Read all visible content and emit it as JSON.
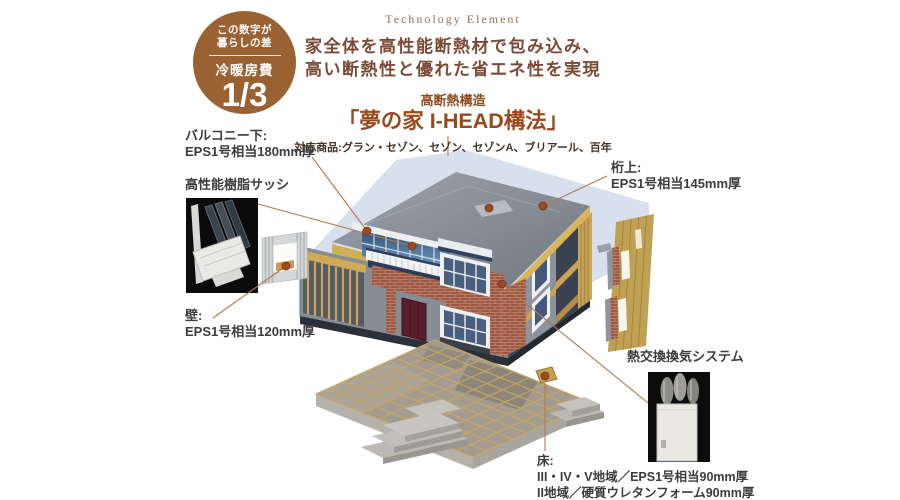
{
  "badge": {
    "line1": "この数字が",
    "line2": "暮らしの差",
    "category": "冷暖房費",
    "value": "1/3",
    "bg_color": "#9a6132"
  },
  "header": {
    "eyebrow": "Technology Element",
    "copy_line1": "家全体を高性能断熱材で包み込み、",
    "copy_line2": "高い断熱性と優れた省エネ性を実現",
    "subtitle": "高断熱構造",
    "title": "「夢の家 I-HEAD構法」",
    "products": "対応商品:グラン・セゾン、セゾン、セゾンA、ブリアール、百年"
  },
  "callouts": {
    "balcony_under": {
      "title": "バルコニー下:",
      "spec": "EPS1号相当180mm厚"
    },
    "resin_sash": {
      "title": "高性能樹脂サッシ"
    },
    "wall": {
      "title": "壁:",
      "spec": "EPS1号相当120mm厚"
    },
    "above_girder": {
      "title": "桁上:",
      "spec": "EPS1号相当145mm厚"
    },
    "heat_exchange_ventilation": {
      "title": "熱交換換気システム"
    },
    "floor": {
      "title": "床:",
      "spec_line1": "III・IV・V地域／EPS1号相当90mm厚",
      "spec_line2": "II地域／硬質ウレタンフォーム90mm厚"
    }
  },
  "illustration": {
    "icons": [
      "callout-dot",
      "callout-line",
      "window-sash-photo",
      "wall-panel-sample",
      "roof-wall-panel-sample",
      "ventilation-unit-photo",
      "house-cutaway",
      "floor-slab"
    ],
    "colors": {
      "badge_bg": "#9a6132",
      "accent_title": "#99491b",
      "label_text": "#3c3c3c",
      "callout_line": "#b5794e",
      "callout_dot": "#9c4a1f",
      "roof_silhouette": "#ccd9e8",
      "wood": "#cfae54",
      "brick": "#9d5743",
      "roof_gray": "#868d96"
    }
  }
}
